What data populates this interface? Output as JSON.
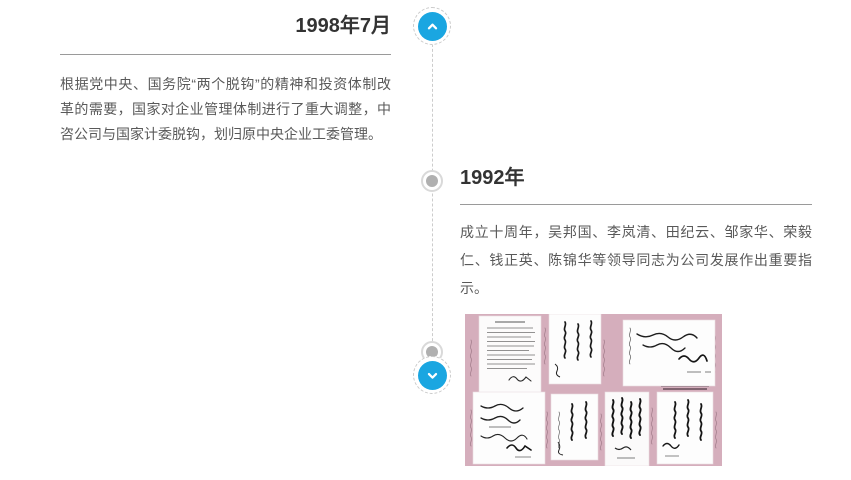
{
  "colors": {
    "accent": "#1aa6e1",
    "heading": "#333333",
    "body": "#595959",
    "divider": "#9a9a9a",
    "dashed-line": "#cccccc",
    "dot": "#b0b0b0",
    "dot-ring": "#d9d9d9",
    "photo-bg": "#d5aebc"
  },
  "timeline": {
    "up_button_icon": "chevron-up",
    "down_button_icon": "chevron-down",
    "entries": [
      {
        "year": "1998年7月",
        "side": "left",
        "text": "根据党中央、国务院“两个脱钩”的精神和投资体制改革的需要，国家对企业管理体制进行了重大调整，中咨公司与国家计委脱钩，划归原中央企业工委管理。"
      },
      {
        "year": "1992年",
        "side": "right",
        "text": "成立十周年，吴邦国、李岚清、田纪云、邹家华、荣毅仁、钱正英、陈锦华等领导同志为公司发展作出重要指示。",
        "image_icon": "leaders-inscriptions-collage-photo"
      }
    ]
  }
}
